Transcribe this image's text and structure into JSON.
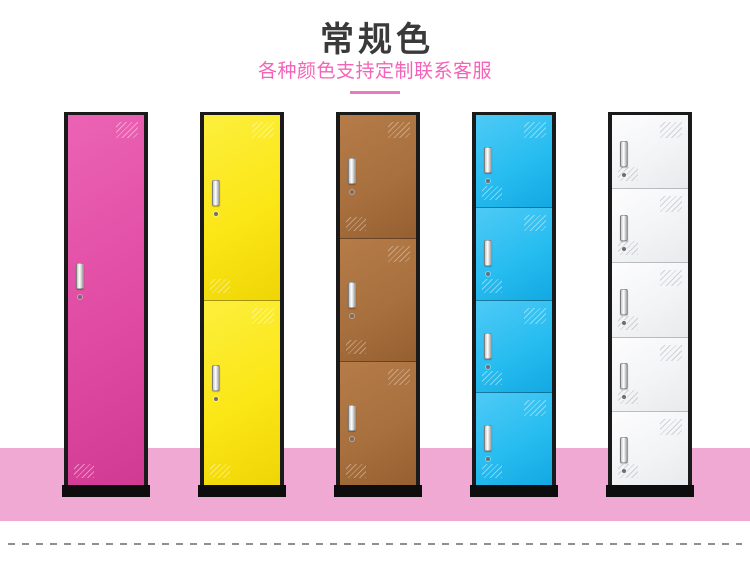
{
  "header": {
    "title": "常规色",
    "subtitle": "各种颜色支持定制联系客服",
    "title_color": "#3a3a3a",
    "subtitle_color": "#f463b7",
    "divider_color": "#ee77c1"
  },
  "lockers": [
    {
      "id": "pink",
      "doors": 1,
      "color": "#e04ba3",
      "color_light": "#eb63b4",
      "color_dark": "#d13a92",
      "shine": "rgba(255,255,255,0.50)"
    },
    {
      "id": "yellow",
      "doors": 2,
      "color": "#fbe616",
      "color_light": "#fdef3d",
      "color_dark": "#efd506",
      "shine": "rgba(255,255,255,0.50)"
    },
    {
      "id": "brown",
      "doors": 3,
      "color": "#a8703e",
      "color_light": "#b57c48",
      "color_dark": "#965f30",
      "shine": "rgba(255,255,255,0.40)"
    },
    {
      "id": "blue",
      "doors": 4,
      "color": "#28bdf0",
      "color_light": "#4ecaf6",
      "color_dark": "#12a8e2",
      "shine": "rgba(255,255,255,0.50)"
    },
    {
      "id": "white",
      "doors": 5,
      "color": "#f3f4f6",
      "color_light": "#fdfdfe",
      "color_dark": "#e8eaec",
      "shine": "rgba(140,140,150,0.40)"
    }
  ],
  "frame_color": "#1a1a1a",
  "base_color": "#0d0d0d",
  "floor_color": "#efa9d3",
  "dash_color": "#8f8f8f"
}
